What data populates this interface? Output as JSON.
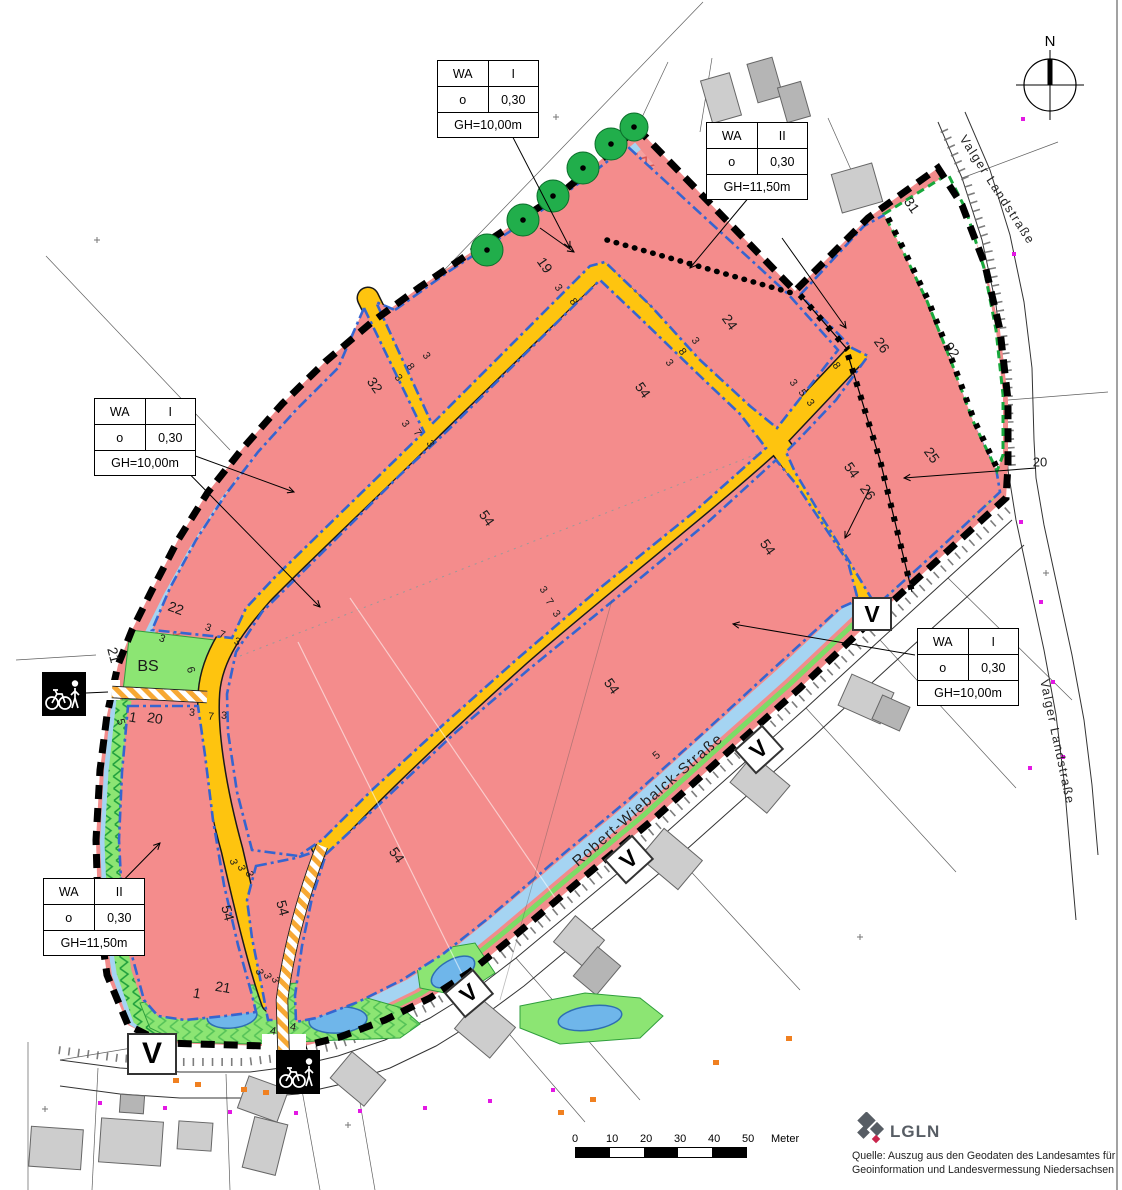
{
  "compass": {
    "north_label": "N"
  },
  "scale_bar": {
    "ticks": [
      "0",
      "10",
      "20",
      "30",
      "40",
      "50"
    ],
    "unit": "Meter"
  },
  "attribution": {
    "logo_text": "LGLN",
    "line1": "Quelle: Auszug aus den Geodaten des Landesamtes für",
    "line2": "Geoinformation und Landesvermessung Niedersachsen"
  },
  "v_marker_label": "V",
  "v_markers": [
    {
      "x": 870,
      "y": 612,
      "rot": 0,
      "w": 36,
      "h": 30
    },
    {
      "x": 757,
      "y": 747,
      "rot": -42,
      "w": 34,
      "h": 29
    },
    {
      "x": 627,
      "y": 857,
      "rot": -42,
      "w": 34,
      "h": 29
    },
    {
      "x": 467,
      "y": 991,
      "rot": -40,
      "w": 34,
      "h": 29
    },
    {
      "x": 150,
      "y": 1052,
      "rot": 0,
      "w": 46,
      "h": 38
    }
  ],
  "wa_boxes": [
    {
      "x": 437,
      "y": 60,
      "zone": "WA",
      "index": "I",
      "bauweise": "o",
      "grz": "0,30",
      "gh": "GH=10,00m"
    },
    {
      "x": 706,
      "y": 122,
      "zone": "WA",
      "index": "II",
      "bauweise": "o",
      "grz": "0,30",
      "gh": "GH=11,50m"
    },
    {
      "x": 94,
      "y": 398,
      "zone": "WA",
      "index": "I",
      "bauweise": "o",
      "grz": "0,30",
      "gh": "GH=10,00m"
    },
    {
      "x": 43,
      "y": 878,
      "zone": "WA",
      "index": "II",
      "bauweise": "o",
      "grz": "0,30",
      "gh": "GH=11,50m"
    },
    {
      "x": 917,
      "y": 628,
      "zone": "WA",
      "index": "I",
      "bauweise": "o",
      "grz": "0,30",
      "gh": "GH=10,00m"
    }
  ],
  "street_labels": [
    {
      "t": "Robert-Wiebalck-Straße",
      "x": 648,
      "y": 800,
      "r": -41,
      "s": 15
    },
    {
      "t": "Valger Landstraße",
      "x": 997,
      "y": 190,
      "r": 57,
      "s": 12.5
    },
    {
      "t": "Valger Landstraße",
      "x": 1057,
      "y": 742,
      "r": 78,
      "s": 12.5
    }
  ],
  "map_labels": [
    {
      "t": "19",
      "x": 545,
      "y": 265,
      "r": 55,
      "s": 14
    },
    {
      "t": "32",
      "x": 375,
      "y": 385,
      "r": 55,
      "s": 14
    },
    {
      "t": "22",
      "x": 176,
      "y": 608,
      "r": 20,
      "s": 14
    },
    {
      "t": "24",
      "x": 730,
      "y": 322,
      "r": 55,
      "s": 14
    },
    {
      "t": "54",
      "x": 643,
      "y": 390,
      "r": 55,
      "s": 14
    },
    {
      "t": "54",
      "x": 487,
      "y": 518,
      "r": 55,
      "s": 14
    },
    {
      "t": "54",
      "x": 852,
      "y": 470,
      "r": 55,
      "s": 14
    },
    {
      "t": "54",
      "x": 768,
      "y": 547,
      "r": 55,
      "s": 14
    },
    {
      "t": "54",
      "x": 612,
      "y": 686,
      "r": 55,
      "s": 14
    },
    {
      "t": "54",
      "x": 397,
      "y": 855,
      "r": 55,
      "s": 14
    },
    {
      "t": "54",
      "x": 228,
      "y": 913,
      "r": 75,
      "s": 14
    },
    {
      "t": "54",
      "x": 283,
      "y": 908,
      "r": 75,
      "s": 14
    },
    {
      "t": "26",
      "x": 882,
      "y": 345,
      "r": 55,
      "s": 14
    },
    {
      "t": "26",
      "x": 868,
      "y": 492,
      "r": 55,
      "s": 14
    },
    {
      "t": "25",
      "x": 932,
      "y": 455,
      "r": 55,
      "s": 14
    },
    {
      "t": "92",
      "x": 952,
      "y": 350,
      "r": 55,
      "s": 14
    },
    {
      "t": "31",
      "x": 912,
      "y": 205,
      "r": 55,
      "s": 14
    },
    {
      "t": "20",
      "x": 155,
      "y": 718,
      "r": 10,
      "s": 14
    },
    {
      "t": "1",
      "x": 133,
      "y": 717,
      "r": 10,
      "s": 14
    },
    {
      "t": "21",
      "x": 114,
      "y": 655,
      "r": 75,
      "s": 14
    },
    {
      "t": "BS",
      "x": 148,
      "y": 667,
      "r": 0,
      "s": 16
    },
    {
      "t": "6",
      "x": 190,
      "y": 670,
      "r": 75,
      "s": 11
    },
    {
      "t": "21",
      "x": 223,
      "y": 987,
      "r": 10,
      "s": 14
    },
    {
      "t": "1",
      "x": 197,
      "y": 993,
      "r": 10,
      "s": 14
    },
    {
      "t": "20",
      "x": 1040,
      "y": 462,
      "r": 0,
      "s": 13
    },
    {
      "t": "5",
      "x": 120,
      "y": 722,
      "r": 75,
      "s": 11
    },
    {
      "t": "5",
      "x": 657,
      "y": 756,
      "r": -40,
      "s": 11
    },
    {
      "t": "3",
      "x": 398,
      "y": 378,
      "r": 55,
      "s": 10.5
    },
    {
      "t": "8",
      "x": 410,
      "y": 367,
      "r": 55,
      "s": 10.5
    },
    {
      "t": "3",
      "x": 426,
      "y": 356,
      "r": 55,
      "s": 10.5
    },
    {
      "t": "3",
      "x": 405,
      "y": 424,
      "r": 55,
      "s": 10.5
    },
    {
      "t": "7",
      "x": 417,
      "y": 433,
      "r": 55,
      "s": 10.5
    },
    {
      "t": "3",
      "x": 430,
      "y": 444,
      "r": 55,
      "s": 10.5
    },
    {
      "t": "3",
      "x": 558,
      "y": 288,
      "r": 55,
      "s": 10.5
    },
    {
      "t": "8",
      "x": 573,
      "y": 302,
      "r": 55,
      "s": 10.5
    },
    {
      "t": "3",
      "x": 669,
      "y": 363,
      "r": 55,
      "s": 10.5
    },
    {
      "t": "8",
      "x": 682,
      "y": 352,
      "r": 55,
      "s": 10.5
    },
    {
      "t": "3",
      "x": 695,
      "y": 341,
      "r": 55,
      "s": 10.5
    },
    {
      "t": "3",
      "x": 793,
      "y": 383,
      "r": 55,
      "s": 10.5
    },
    {
      "t": "5",
      "x": 802,
      "y": 393,
      "r": 55,
      "s": 10.5
    },
    {
      "t": "3",
      "x": 810,
      "y": 403,
      "r": 55,
      "s": 10.5
    },
    {
      "t": "8",
      "x": 836,
      "y": 366,
      "r": 55,
      "s": 10.5
    },
    {
      "t": "3",
      "x": 543,
      "y": 590,
      "r": 55,
      "s": 10.5
    },
    {
      "t": "7",
      "x": 549,
      "y": 602,
      "r": 55,
      "s": 10.5
    },
    {
      "t": "3",
      "x": 556,
      "y": 614,
      "r": 55,
      "s": 10.5
    },
    {
      "t": "3",
      "x": 208,
      "y": 628,
      "r": 20,
      "s": 10.5
    },
    {
      "t": "7",
      "x": 222,
      "y": 635,
      "r": 20,
      "s": 10.5
    },
    {
      "t": "3",
      "x": 237,
      "y": 642,
      "r": 20,
      "s": 10.5
    },
    {
      "t": "3",
      "x": 192,
      "y": 713,
      "r": 5,
      "s": 10.5
    },
    {
      "t": "7",
      "x": 211,
      "y": 717,
      "r": 5,
      "s": 10.5
    },
    {
      "t": "3",
      "x": 224,
      "y": 716,
      "r": 5,
      "s": 10.5
    },
    {
      "t": "3",
      "x": 162,
      "y": 639,
      "r": 20,
      "s": 10.5
    },
    {
      "t": "3",
      "x": 233,
      "y": 862,
      "r": 75,
      "s": 10.5
    },
    {
      "t": "3",
      "x": 241,
      "y": 868,
      "r": 75,
      "s": 10.5
    },
    {
      "t": "3",
      "x": 249,
      "y": 874,
      "r": 75,
      "s": 10.5
    },
    {
      "t": "3",
      "x": 259,
      "y": 972,
      "r": 75,
      "s": 10.5
    },
    {
      "t": "3",
      "x": 267,
      "y": 976,
      "r": 75,
      "s": 10.5
    },
    {
      "t": "3",
      "x": 275,
      "y": 980,
      "r": 75,
      "s": 10.5
    },
    {
      "t": "4",
      "x": 273,
      "y": 1032,
      "r": 10,
      "s": 11
    },
    {
      "t": "4",
      "x": 293,
      "y": 1028,
      "r": 10,
      "s": 11
    }
  ],
  "colors": {
    "residential_pink": "#F48C8C",
    "road_orange": "#FEC40F",
    "parcel_edge_blue": "#3565D0",
    "strip_lightblue": "#A5D4F2",
    "green_area": "#8CE573",
    "tree_green": "#21AE4B",
    "basin_blue": "#6FB6EA",
    "boundary_black": "#000000",
    "marker_magenta": "#E318E3",
    "marker_orange": "#F08020",
    "lgln_grey": "#575D64",
    "lgln_red": "#C9244B"
  }
}
